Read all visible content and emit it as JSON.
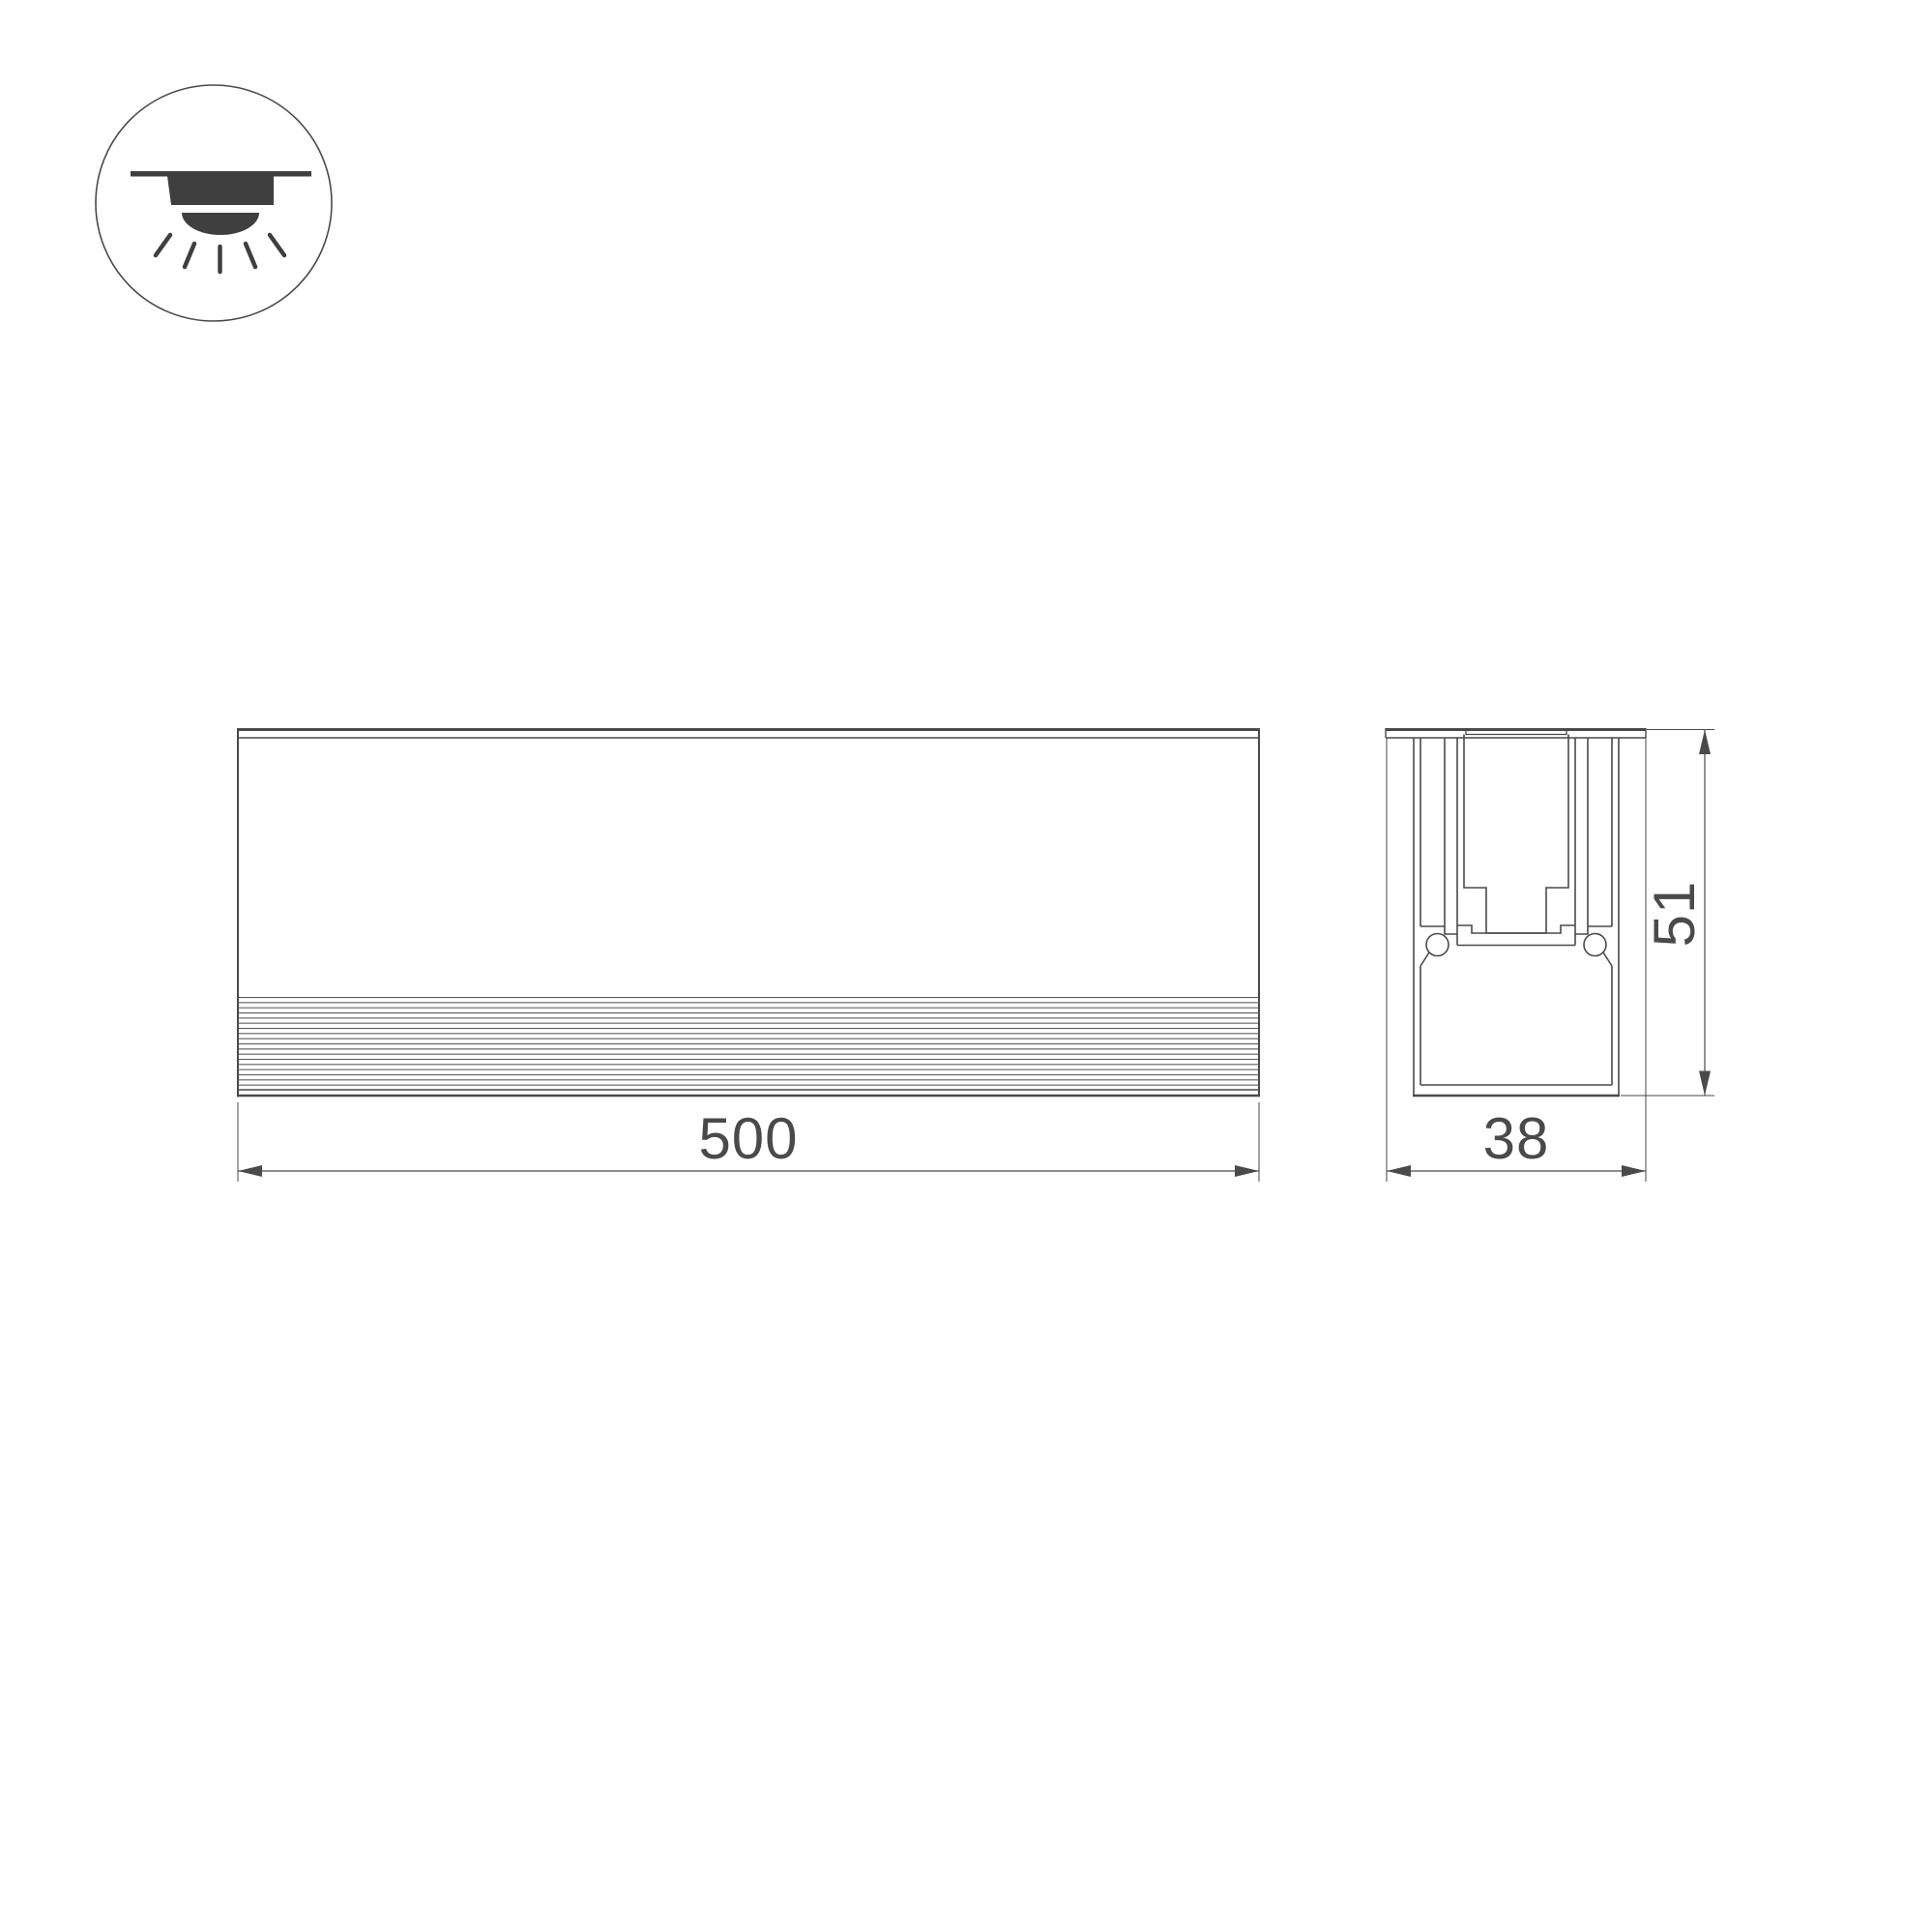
{
  "page": {
    "background": "#ffffff"
  },
  "drawing": {
    "line_color": "#4a4a4a",
    "rib_line_color": "#585858",
    "icon": {
      "name": "recessed-downlight-ceiling-icon",
      "fill_color": "#3f3f3f"
    },
    "views": {
      "front_view": {
        "length_label": "500"
      },
      "section_view": {
        "width_label": "38",
        "height_label": "51"
      }
    }
  }
}
